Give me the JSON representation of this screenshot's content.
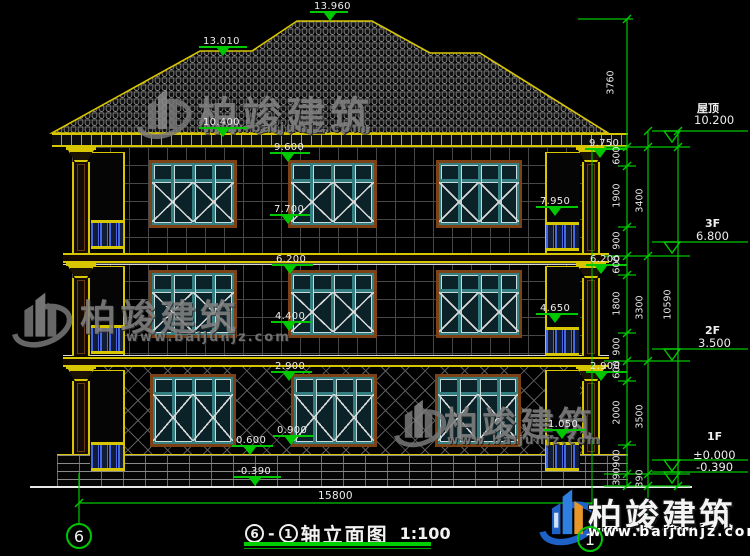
{
  "drawing": {
    "title": {
      "axis_start": "6",
      "separator": "-",
      "axis_end": "1",
      "name": "轴立面图",
      "scale": "1:100"
    },
    "axis_bubbles": {
      "left": "6",
      "right": "1"
    },
    "bottom_dimension": "15800",
    "elevation_marks": [
      "13.960",
      "13.010",
      "10.400",
      "9.600",
      "9.750",
      "7.700",
      "7.950",
      "6.200",
      "6.200",
      "4.400",
      "4.650",
      "2.900",
      "2.900",
      "0.900",
      "0.600",
      "1.050",
      "-0.390"
    ],
    "dim_chains": {
      "roof_height": "3760",
      "chain1": [
        "600",
        "1900",
        "900",
        "600",
        "1800",
        "900",
        "600",
        "2000",
        "900",
        "390"
      ],
      "chain2": [
        "3400",
        "3300",
        "3500",
        "390"
      ],
      "overall": "10590"
    },
    "floor_levels": [
      {
        "label": "屋顶",
        "value": "10.200"
      },
      {
        "label": "3F",
        "value": "6.800"
      },
      {
        "label": "2F",
        "value": "3.500"
      },
      {
        "label": "1F",
        "value": "±0.000",
        "value_below": "-0.390"
      }
    ]
  },
  "watermark": {
    "brand": "柏竣建筑",
    "url": "www.baijunjz.com"
  },
  "colors": {
    "line_green": "#00c800",
    "cad_yellow": "#d8c600",
    "frame_brown": "#7c4216",
    "window_teal": "#357f83",
    "baluster_blue": "#4468e0",
    "logo_blue": "#1e62c8",
    "logo_orange": "#e8962a"
  }
}
